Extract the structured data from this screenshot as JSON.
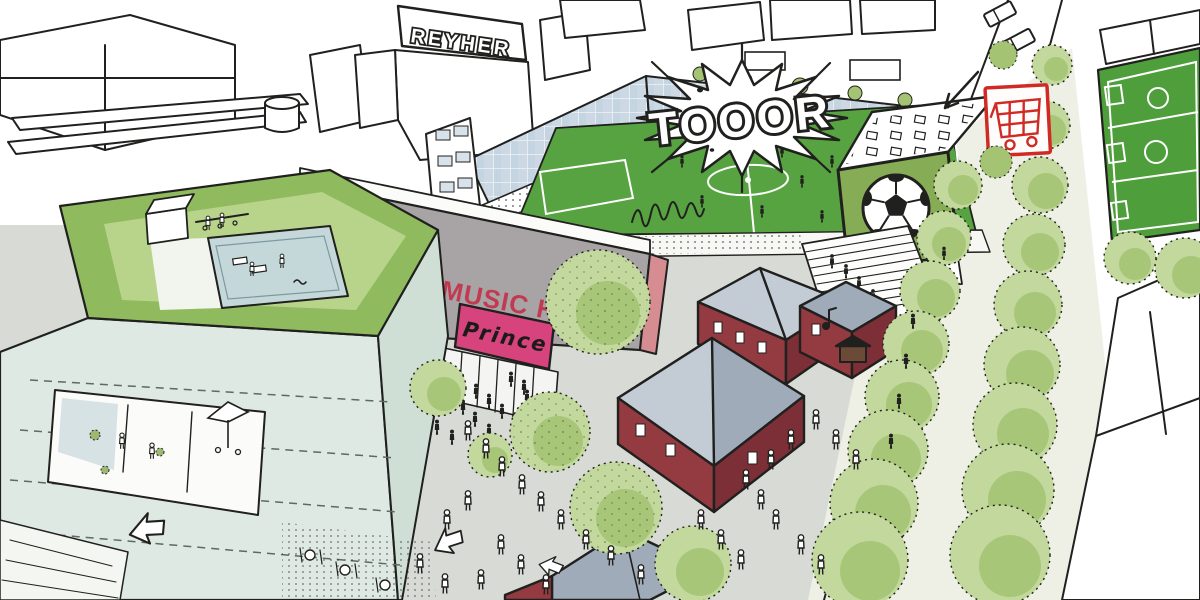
{
  "meta": {
    "scene_type": "hand-drawn aerial architectural sketch",
    "description": "Urban design illustration: stadium with soccer pitch and glass grandstands, music hall with marquee, rooftop pool garden, plaza with crowds, red brick buildings and a tree-lined boulevard"
  },
  "labels": {
    "factory_sign": "REYHER",
    "goal_cheer": "TOOOR",
    "music_hall_sign": "MUSIC HALL",
    "marquee_sign": "Prince"
  },
  "colors": {
    "ink": "#20201e",
    "paper": "#ffffff",
    "field_green": "#58a341",
    "pitch_dark": "#4f9e3c",
    "glass_blue": "#ccd9e4",
    "glass_line": "#eef3f7",
    "mint": "#dfe9e3",
    "mint_shade": "#cfdfd6",
    "lawn": "#b7d48a",
    "lawn_edge": "#8fba5e",
    "pool": "#c4d8da",
    "grey_wall": "#a8a4a6",
    "salmon": "#d68d92",
    "plaza": "#d8dbd5",
    "brick_red": "#943a41",
    "brick_dark": "#7c2f36",
    "roof_grey": "#9fabb9",
    "roof_light": "#c3cbd5",
    "tree_light": "#c2d89c",
    "tree_mid": "#a4c474",
    "tree_dark": "#86ad56",
    "sign_pink": "#d7437d",
    "sign_red": "#c23a52",
    "cart_red": "#cf2b24",
    "pale_ground": "#eef0e5",
    "white_warm": "#f7f8f4"
  }
}
